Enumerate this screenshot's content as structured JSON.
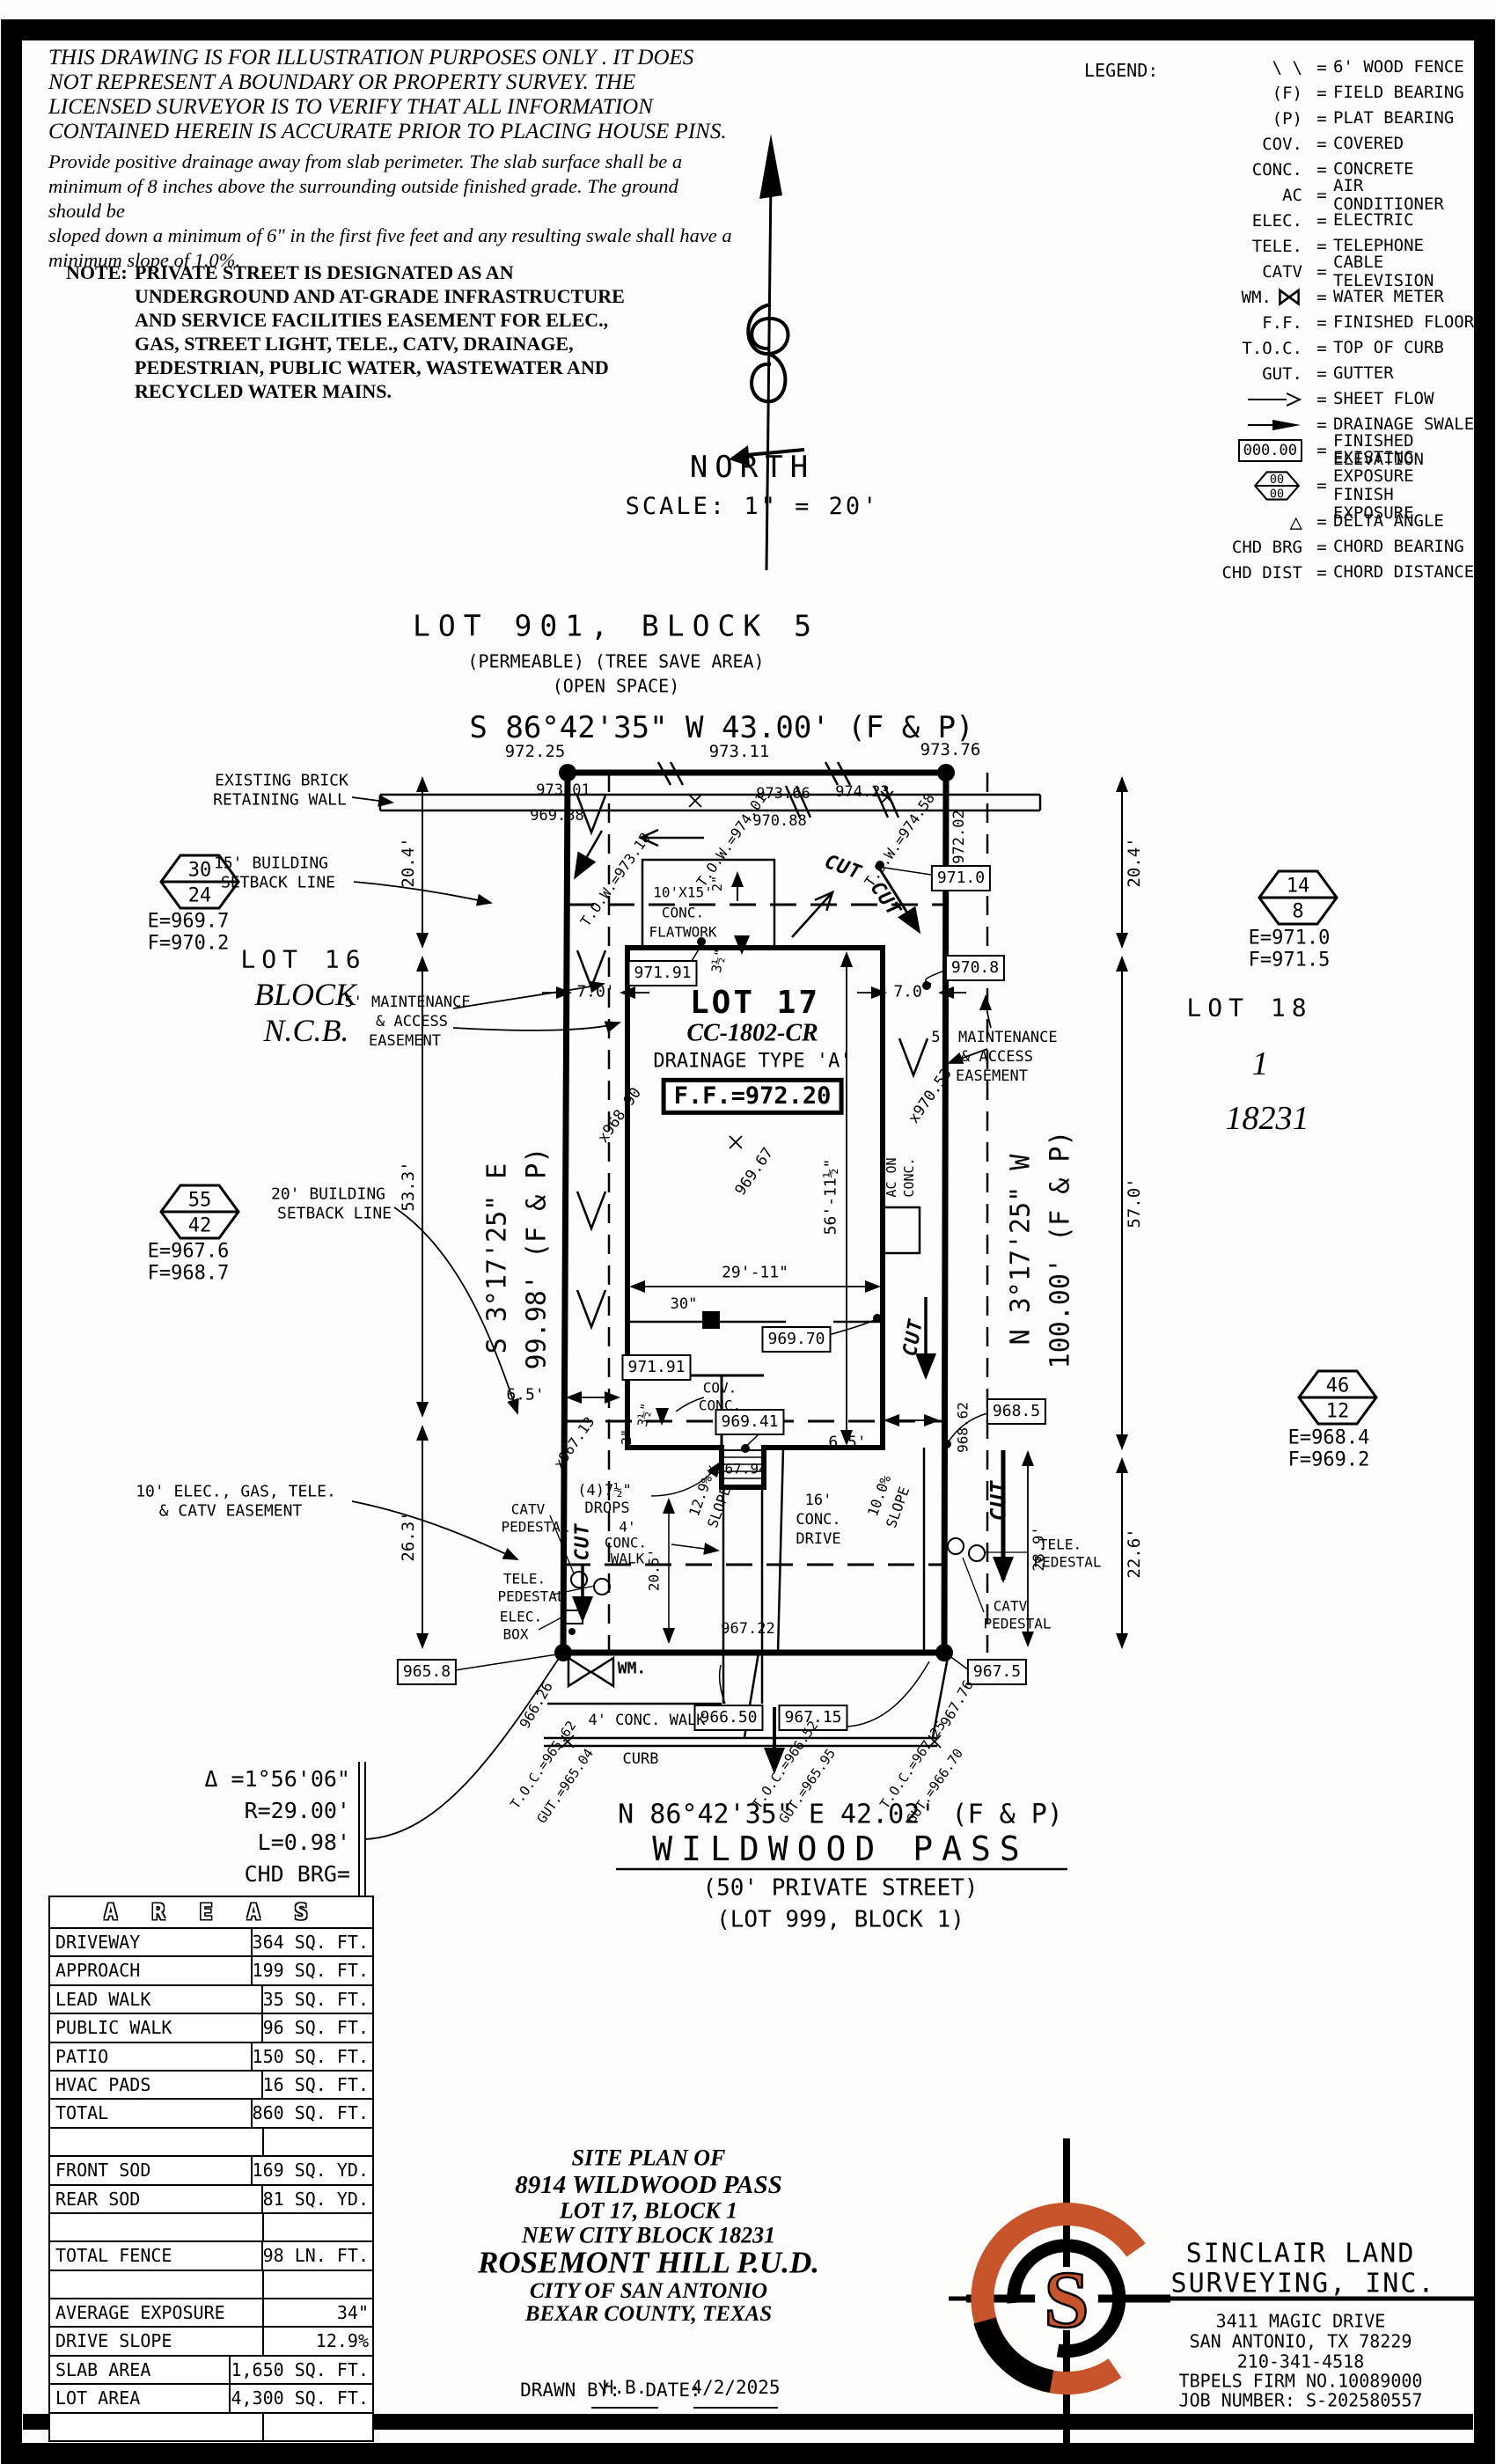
{
  "disclaimer": {
    "p1": [
      "THIS DRAWING IS FOR ILLUSTRATION PURPOSES ONLY . IT DOES",
      "NOT REPRESENT A BOUNDARY OR PROPERTY SURVEY. THE",
      "LICENSED SURVEYOR IS TO VERIFY THAT ALL INFORMATION",
      "CONTAINED HEREIN IS ACCURATE PRIOR TO PLACING HOUSE PINS."
    ],
    "p2": [
      "Provide positive drainage away from slab perimeter. The slab surface shall be a",
      "minimum of 8 inches above the surrounding outside finished grade. The ground should be",
      "sloped down a minimum of 6\" in the first five feet and any resulting swale shall have a",
      "minimum slope of 1.0%."
    ],
    "note_label": "NOTE:",
    "note": [
      "PRIVATE STREET IS DESIGNATED AS AN",
      "UNDERGROUND AND AT-GRADE INFRASTRUCTURE",
      "AND SERVICE FACILITIES EASEMENT FOR ELEC.,",
      "GAS, STREET LIGHT, TELE., CATV, DRAINAGE,",
      "PEDESTRIAN, PUBLIC WATER, WASTEWATER AND",
      "RECYCLED WATER MAINS."
    ]
  },
  "compass": {
    "north": "NORTH",
    "scale": "SCALE: 1\" = 20'"
  },
  "legend": {
    "title": "LEGEND:",
    "items": [
      {
        "sym": "\\ \\",
        "eq": "=",
        "desc": "6' WOOD FENCE"
      },
      {
        "sym": "(F)",
        "eq": "=",
        "desc": "FIELD BEARING"
      },
      {
        "sym": "(P)",
        "eq": "=",
        "desc": "PLAT BEARING"
      },
      {
        "sym": "COV.",
        "eq": "=",
        "desc": "COVERED"
      },
      {
        "sym": "CONC.",
        "eq": "=",
        "desc": "CONCRETE"
      },
      {
        "sym": "AC",
        "eq": "=",
        "desc": "AIR CONDITIONER"
      },
      {
        "sym": "ELEC.",
        "eq": "=",
        "desc": "ELECTRIC"
      },
      {
        "sym": "TELE.",
        "eq": "=",
        "desc": "TELEPHONE"
      },
      {
        "sym": "CATV",
        "eq": "=",
        "desc": "CABLE TELEVISION"
      },
      {
        "sym": "WM.",
        "icon": "⋈",
        "eq": "=",
        "desc": "WATER METER"
      },
      {
        "sym": "F.F.",
        "eq": "=",
        "desc": "FINISHED FLOOR"
      },
      {
        "sym": "T.O.C.",
        "eq": "=",
        "desc": "TOP OF CURB"
      },
      {
        "sym": "GUT.",
        "eq": "=",
        "desc": "GUTTER"
      },
      {
        "sym": "",
        "eq": "=",
        "desc": "SHEET FLOW"
      },
      {
        "sym": "",
        "eq": "=",
        "desc": "DRAINAGE SWALE"
      },
      {
        "sym": "000.00",
        "eq": "=",
        "desc": "FINISHED ELEVATION"
      },
      {
        "sym1": "00",
        "sym2": "00",
        "eq": "=",
        "desc1": "EXISTING EXPOSURE",
        "desc2": "FINISH EXPOSURE"
      },
      {
        "sym": "△",
        "eq": "=",
        "desc": "DELTA ANGLE"
      },
      {
        "sym": "CHD BRG",
        "eq": "=",
        "desc": "CHORD BEARING"
      },
      {
        "sym": "CHD DIST",
        "eq": "=",
        "desc": "CHORD DISTANCE"
      }
    ]
  },
  "header": {
    "lot901": "LOT 901, BLOCK 5",
    "permeable": "(PERMEABLE) (TREE SAVE AREA)",
    "open_space": "(OPEN SPACE)",
    "bearing_top": "S 86°42'35\" W 43.00' (F & P)"
  },
  "plat": {
    "e97225": "972.25",
    "e97311": "973.11",
    "e97376": "973.76",
    "wall1": "EXISTING BRICK",
    "wall2": "RETAINING WALL",
    "e97301": "973.01",
    "e96988": "969.88",
    "e97366": "973.66",
    "e97088": "970.88",
    "e97423": "974.23",
    "tow318": "T.O.W.=973.18",
    "tow401": "T.O.W.=974.01",
    "tow458": "T.O.W.=974.58",
    "e97202": "972.02",
    "dim204": "20.4'",
    "sb15a": "15' BUILDING",
    "sb15b": "SETBACK LINE",
    "box9710": "971.0",
    "fw1": "10'X15'",
    "fw2": "CONC.",
    "fw3": "FLATWORK",
    "in2": "2\"",
    "d312": "3½\"",
    "cut": "CUT",
    "box97191": "971.91",
    "dim70": "7.0'",
    "box9708": "970.8",
    "me1": "5' MAINTENANCE",
    "me2": "& ACCESS",
    "me3": "EASEMENT",
    "lot16": "LOT 16",
    "blockw": "BLOCK",
    "ncb": "N.C.B.",
    "lot18": "LOT 18",
    "blockn": "1",
    "ncbn": "18231",
    "h30": "30",
    "h24": "24",
    "h30e": "E=969.7",
    "h30f": "F=970.2",
    "h14": "14",
    "h8": "8",
    "h14e": "E=971.0",
    "h14f": "F=971.5",
    "h55": "55",
    "h42": "42",
    "h55e": "E=967.6",
    "h55f": "F=968.7",
    "h46": "46",
    "h12": "12",
    "h46e": "E=968.4",
    "h46f": "F=969.2",
    "lot17": "LOT 17",
    "cc": "CC-1802-CR",
    "dt": "DRAINAGE TYPE 'A'",
    "ff": "F.F.=972.20",
    "e96967": "969.67",
    "x96890": "x968.90",
    "x97053": "x970.53",
    "x96713": "x967.13",
    "x96794": "x967.94",
    "brgL1": "S 3°17'25\" E",
    "brgL2": "99.98' (F & P)",
    "brgR1": "N 3°17'25\" W",
    "brgR2": "100.00' (F & P)",
    "d533": "53.3'",
    "d263": "26.3'",
    "d570": "57.0'",
    "d226": "22.6'",
    "d289": "28.9'",
    "d2911": "29'-11\"",
    "d5611": "56'-11½\"",
    "d30in": "30\"",
    "ac1": "AC ON",
    "ac2": "CONC.",
    "box96970": "969.70",
    "d65": "6.5'",
    "box96941": "969.41",
    "box9685": "968.5",
    "e96862": "968.62",
    "cov1": "COV.",
    "cov2": "CONC.",
    "drops1": "(4)7½\"",
    "drops2": "DROPS",
    "w41": "4'",
    "w42": "CONC.",
    "w43": "WALK",
    "d205": "20.5'",
    "sl129": "12.9%",
    "slw": "SLOPE",
    "dr161": "16'",
    "dr162": "CONC.",
    "dr163": "DRIVE",
    "sl100": "10.0%",
    "e96722": "967.22",
    "catv": "CATV",
    "tele": "TELE.",
    "elec": "ELEC.",
    "pedestal": "PEDESTAL",
    "boxw": "BOX",
    "wm": "WM.",
    "box9658": "965.8",
    "x96626": "966.26",
    "box96650": "966.50",
    "box96715": "967.15",
    "box9675": "967.5",
    "x96776": "967.76",
    "sb20a": "20' BUILDING",
    "sb20b": "SETBACK LINE",
    "e10a": "10' ELEC., GAS, TELE.",
    "e10b": "& CATV EASEMENT"
  },
  "curve": {
    "d": "Δ =1°56'06\"",
    "r": "R=29.00'",
    "l": "L=0.98'",
    "b1": "CHD BRG=",
    "b2": "N 87°40'38\" E",
    "cd": "CHD DIST=0.98'"
  },
  "street": {
    "wlk": "4' CONC. WALK",
    "curb": "CURB",
    "tocl": "T.O.C.=965.62",
    "gutl": "GUT.=965.04",
    "tocm": "T.O.C.=966.52",
    "gutm": "GUT.=965.95",
    "tocr": "T.O.C.=967.25",
    "gutr": "GUT.=966.70",
    "brg": "N 86°42'35\" E 42.02' (F & P)",
    "name": "WILDWOOD PASS",
    "priv": "(50' PRIVATE STREET)",
    "lot999": "(LOT 999, BLOCK 1)"
  },
  "areas": {
    "title": "A R E A S",
    "rows": [
      {
        "label": "DRIVEWAY",
        "value": "364 SQ. FT."
      },
      {
        "label": "APPROACH",
        "value": "199 SQ. FT."
      },
      {
        "label": "LEAD WALK",
        "value": "35 SQ. FT."
      },
      {
        "label": "PUBLIC WALK",
        "value": "96 SQ. FT."
      },
      {
        "label": "PATIO",
        "value": "150 SQ. FT."
      },
      {
        "label": "HVAC PADS",
        "value": "16 SQ. FT."
      },
      {
        "label": "TOTAL",
        "value": "860 SQ. FT."
      },
      {
        "label": "",
        "value": ""
      },
      {
        "label": "FRONT SOD",
        "value": "169 SQ. YD."
      },
      {
        "label": "REAR SOD",
        "value": "81 SQ. YD."
      },
      {
        "label": "",
        "value": ""
      },
      {
        "label": "TOTAL FENCE",
        "value": "98 LN. FT."
      },
      {
        "label": "",
        "value": ""
      },
      {
        "label": "AVERAGE EXPOSURE",
        "value": "34\""
      },
      {
        "label": "DRIVE SLOPE",
        "value": "12.9%"
      },
      {
        "label": "SLAB AREA",
        "value": "1,650 SQ. FT."
      },
      {
        "label": "LOT AREA",
        "value": "4,300 SQ. FT."
      },
      {
        "label": "",
        "value": ""
      }
    ]
  },
  "titleblock": {
    "lines": [
      "SITE PLAN OF",
      "8914 WILDWOOD PASS",
      "LOT 17, BLOCK 1",
      "NEW CITY BLOCK 18231",
      "ROSEMONT HILL P.U.D.",
      "CITY OF SAN ANTONIO",
      "BEXAR COUNTY, TEXAS"
    ],
    "drawn_by_label": "DRAWN BY:",
    "drawn_by": "H.B.",
    "date_label": "DATE:",
    "date": "4/2/2025"
  },
  "surveyor": {
    "name1": "SINCLAIR LAND",
    "name2": "SURVEYING, INC.",
    "a0": "3411 MAGIC DRIVE",
    "a1": "SAN ANTONIO, TX 78229",
    "a2": "210-341-4518",
    "a3": "TBPELS FIRM NO.10089000",
    "a4": "JOB NUMBER: S-202580557",
    "logo_letter": "S"
  },
  "colors": {
    "logo_orange": "#c8542c",
    "ink": "#000000"
  }
}
